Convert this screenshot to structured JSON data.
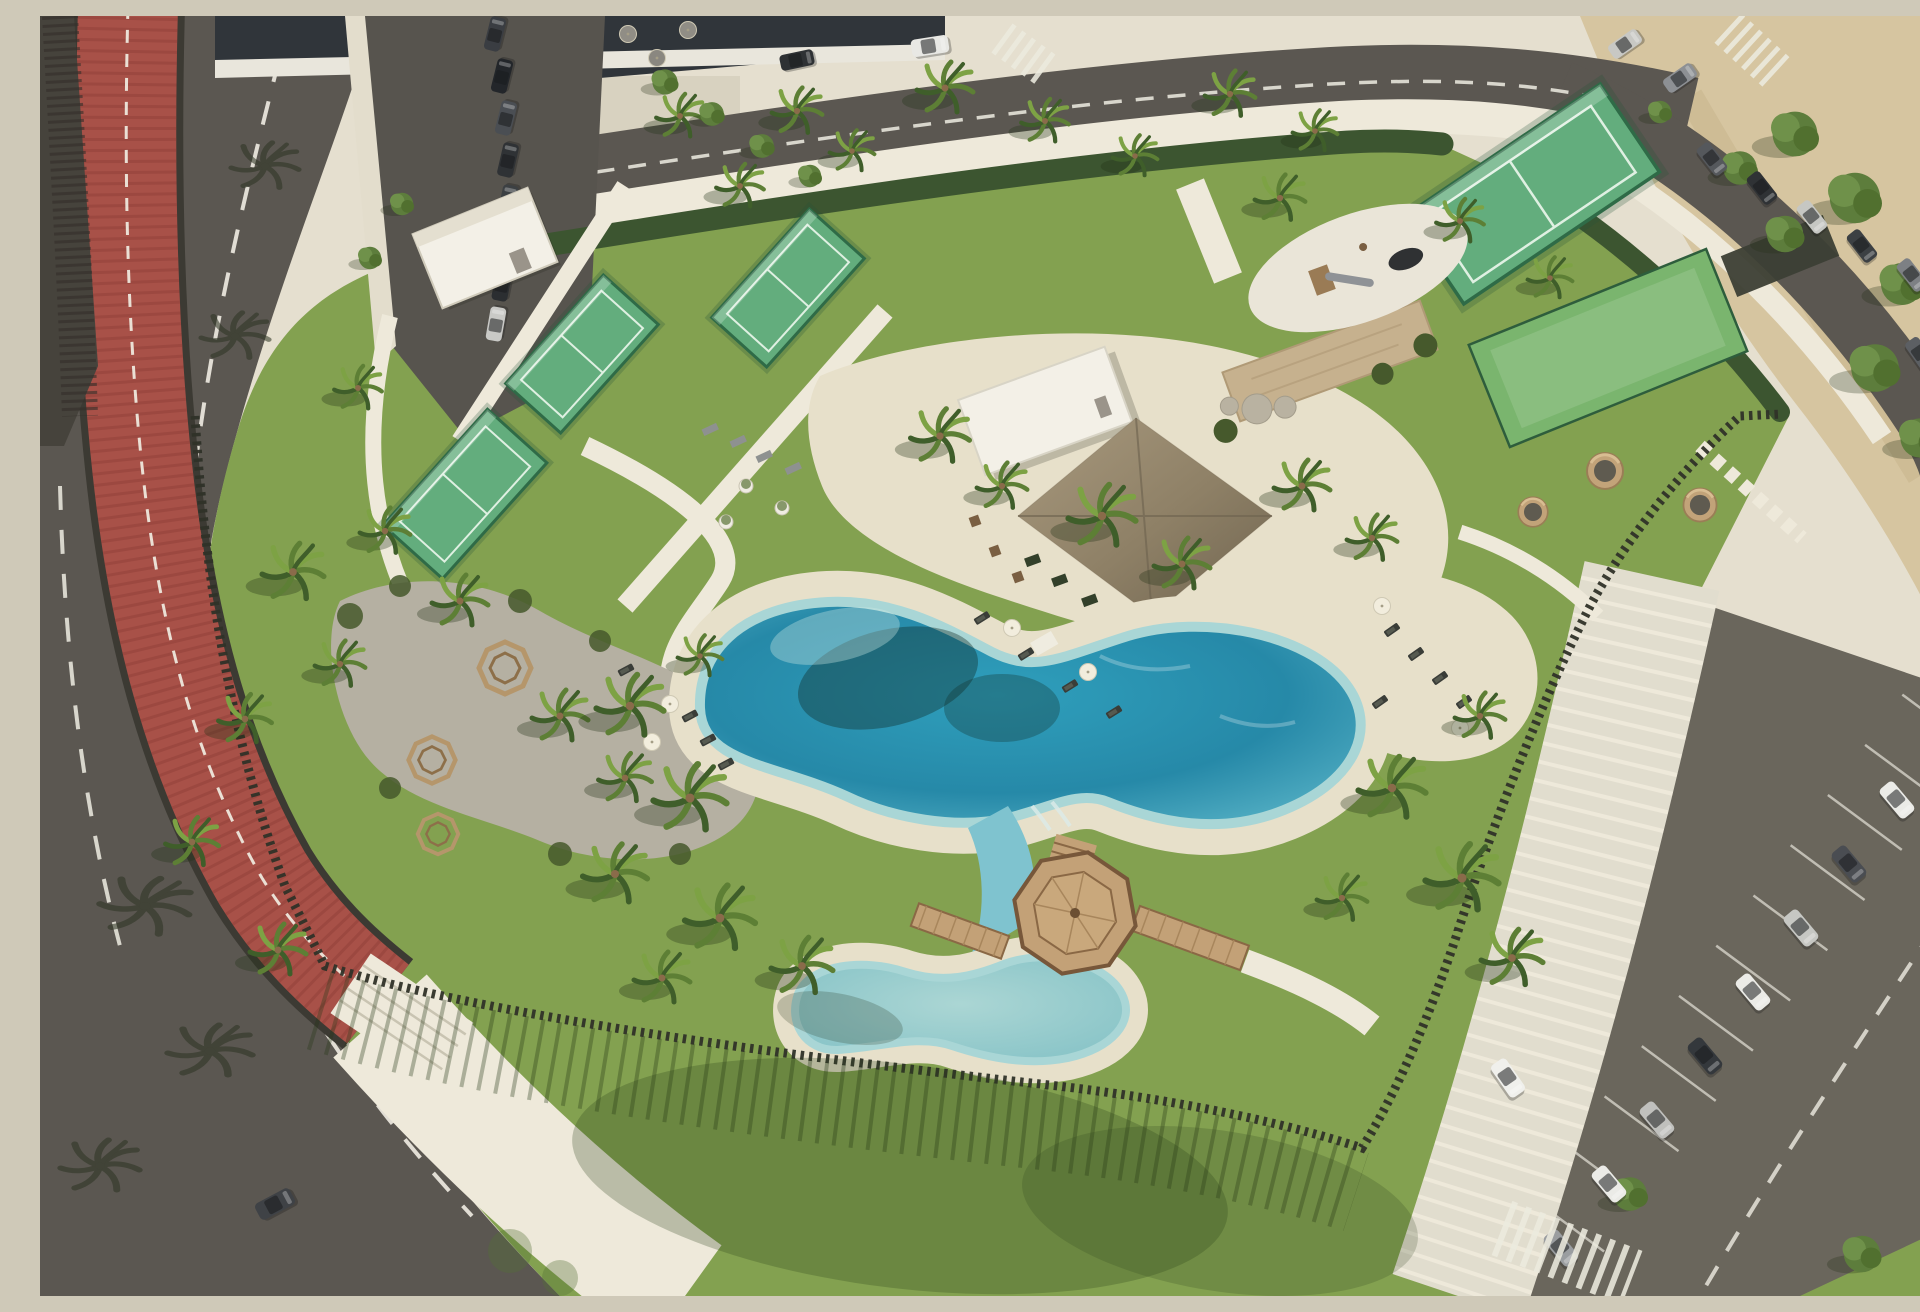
{
  "meta": {
    "title": "Aerial drone view of a resort amenity park with lagoon pools, padel courts and parking",
    "description": "Oblique aerial render on a sunny day: a landscaped club park bordered on the left by a curved road with a red cycle lane, on the top by a street with buildings and parked cars, on the right by a sandy lot and an angled parking area. Inside the park: four fenced green padel courts, a white changing-room building, a central pavilion with a large thatched roof, a stone feature wall with boulders, a playground oval with a slide, a light-green lawn games court, a free-form turquoise lagoon pool ringed by sand with white umbrellas and dark sun loungers, a smaller pale kids pool connected by a water channel under an octagonal timber gazebo with plank bridges, gravel seating pods with octagonal benches, round wicker day-bed pods, many palm trees, dark slatted perimeter fences casting long striped shadows, and wide lawns."
  },
  "palette": {
    "asphalt": "#5b5751",
    "asphaltDark": "#524e48",
    "roadLine": "#efece2",
    "bike": "#a85148",
    "bikeDark": "#8e3f37",
    "pave": "#d8d2c0",
    "paveLight": "#e5dfcf",
    "paveWhite": "#eee9da",
    "sand": "#d6c5a0",
    "beach": "#e7e0ca",
    "grass": "#83a150",
    "grassDark": "#6d8b42",
    "hedge": "#3c5530",
    "frond": "#5d7f35",
    "frondL": "#7da244",
    "frondD": "#3f5e2a",
    "trunk": "#8a6b4a",
    "court": "#63ad7d",
    "courtFrame": "#2f6b47",
    "courtLine": "#dff0e2",
    "lawnCourt": "#7ab56e",
    "water": "#2e9db9",
    "waterDeep": "#1f7e9d",
    "waterLight": "#79c7d4",
    "waterPale": "#a9d6d6",
    "waterKids": "#8fc7c9",
    "thatch": "#8e8066",
    "thatchDark": "#6f6450",
    "thatchLight": "#a8997e",
    "wood": "#a97f5c",
    "woodDark": "#6b4f33",
    "deck": "#c3a177",
    "white": "#f3f0e7",
    "stone": "#c6b18e",
    "boulder": "#b9b2a1",
    "fence": "#2f3128",
    "gravel": "#b5b0a2",
    "carDark": "#33363a",
    "carGrey": "#7d8084",
    "carSilver": "#c6c7c3",
    "carWhite": "#ebebe7",
    "umbrella": "#f2eddd",
    "shadow": "rgba(35,50,22,0.32)"
  },
  "scene": {
    "regions": [
      {
        "name": "left-road",
        "label": "Curved asphalt road with white dashed lane lines"
      },
      {
        "name": "bike-path",
        "label": "Red slatted cycle path with dashed centre line ending at white steps"
      },
      {
        "name": "top-street",
        "label": "Upper street with dashed centre line, zebra crossings and white van"
      },
      {
        "name": "buildings",
        "label": "Glass-fronted buildings with white canopy and red benches"
      },
      {
        "name": "street-parking",
        "label": "Row of dark cars parked along the upper-left street"
      },
      {
        "name": "sand-lot",
        "label": "Sandy vacant ground in the top-right corner"
      },
      {
        "name": "padel-courts",
        "label": "Four fenced green padel courts"
      },
      {
        "name": "changing-building",
        "label": "Small white flat-roof building beside the courts"
      },
      {
        "name": "pavilion",
        "label": "Club pavilion: white volume plus large thatched hip roof"
      },
      {
        "name": "stone-wall",
        "label": "Stone feature wall with boulders and shrubs"
      },
      {
        "name": "playground",
        "label": "White playground oval with timber tower, slide and black dome"
      },
      {
        "name": "lawn-court",
        "label": "Light-green multi-games lawn court with dark canopy"
      },
      {
        "name": "main-pool",
        "label": "Free-form turquoise lagoon pool with sandy beach edge"
      },
      {
        "name": "kids-pool",
        "label": "Smaller pale kids pool linked by a water channel"
      },
      {
        "name": "gazebo",
        "label": "Octagonal timber gazebo deck with plank bridges"
      },
      {
        "name": "seating-pods",
        "label": "Gravel area with octagonal timber benches under palms"
      },
      {
        "name": "wicker-pods",
        "label": "Round wicker day-bed pods on the lawn"
      },
      {
        "name": "loungers",
        "label": "Dark sun loungers and white parasols around the pool"
      },
      {
        "name": "perimeter-fence",
        "label": "Dark vertical-slat fence casting long striped shadows"
      },
      {
        "name": "walkway",
        "label": "Pale paved pedestrian walkway along the parking"
      },
      {
        "name": "parking-lot",
        "label": "Angled parking bays with white and silver cars, zebra crossing"
      },
      {
        "name": "palms",
        "label": "Numerous palm trees with cast shadows"
      }
    ],
    "counts": {
      "padel_courts": 4,
      "lawn_courts": 1,
      "pools": 2,
      "gazebos": 1,
      "cars_upper_left_row": 8,
      "cars_top_right": 8,
      "cars_lower_lot": 10,
      "car_maneuvering": 1,
      "cars_on_road": 3,
      "parasols": 8,
      "sun_loungers": 13,
      "wicker_pods": 4,
      "octagonal_benches": 3,
      "planter_pots": 3,
      "zebra_crossings": 3
    }
  }
}
